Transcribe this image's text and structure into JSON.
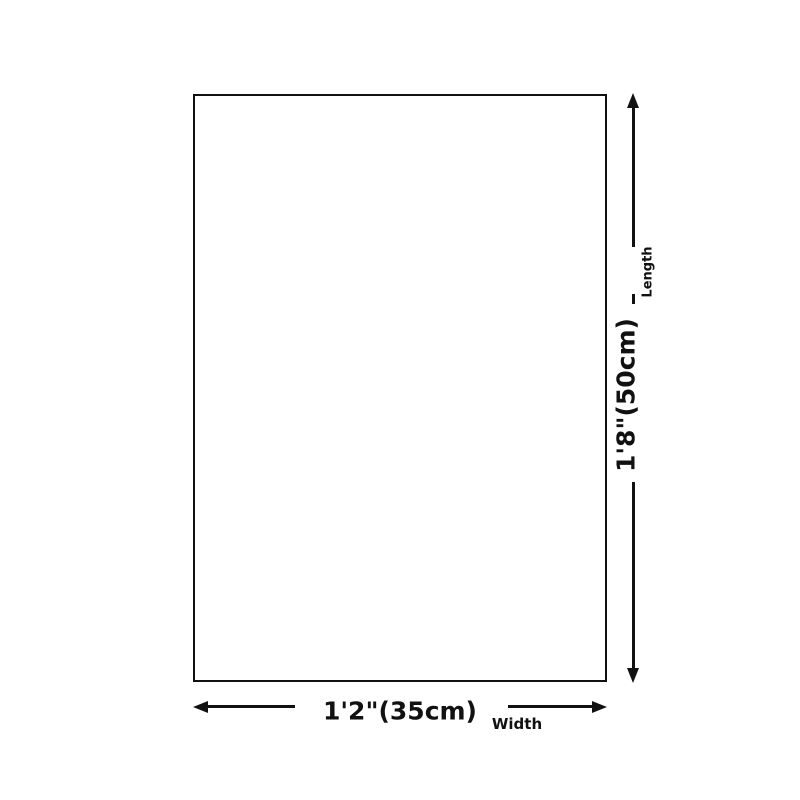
{
  "diagram": {
    "type": "product-dimension-diagram",
    "colors": {
      "background": "#ffffff",
      "line": "#111111",
      "text": "#111111"
    },
    "vertical_dimension": {
      "value": "1'8\"(50cm)",
      "label": "Length"
    },
    "horizontal_dimension": {
      "value": "1'2\"(35cm)",
      "label": "Width"
    }
  }
}
